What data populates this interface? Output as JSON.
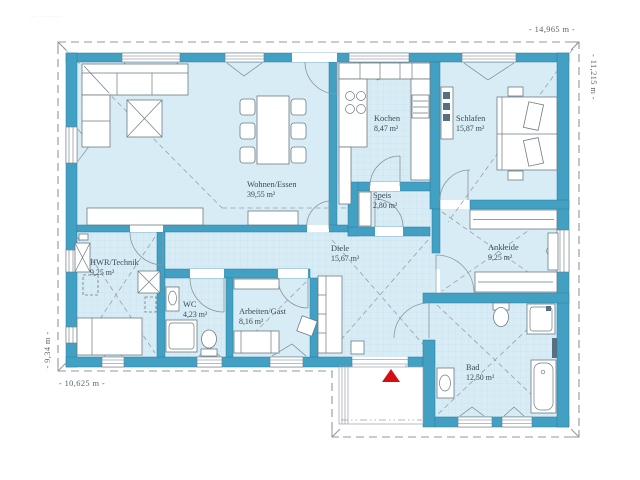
{
  "fineprint": "···· ·· ·······",
  "dimensions": {
    "top": "- 14,965 m -",
    "right": "- 11,215 m -",
    "left": "- 9,34 m -",
    "bottom": "- 10,625 m -"
  },
  "rooms": {
    "wohnen": {
      "name": "Wohnen/Essen",
      "area": "39,55 m²"
    },
    "kochen": {
      "name": "Kochen",
      "area": "8,47 m²"
    },
    "schlafen": {
      "name": "Schlafen",
      "area": "15,87 m²"
    },
    "speis": {
      "name": "Speis",
      "area": "2,80 m²"
    },
    "diele": {
      "name": "Diele",
      "area": "15,67 m²"
    },
    "hwr": {
      "name": "HWR/Technik",
      "area": "9,25 m²"
    },
    "wc": {
      "name": "WC",
      "area": "4,23 m²"
    },
    "arbeiten": {
      "name": "Arbeiten/Gast",
      "area": "8,16 m²"
    },
    "ankleide": {
      "name": "Ankleide",
      "area": "9,25 m²"
    },
    "bad": {
      "name": "Bad",
      "area": "12,50 m²"
    }
  },
  "colors": {
    "wall": "#42a0c3",
    "floor": "#d8ecf6",
    "tile_line": "#c3ddeb",
    "roof_line": "#97a1a8",
    "furniture_line": "#6e7b83",
    "label_text": "#3a4a55",
    "dimension_text": "#5a646e",
    "entrance_arrow": "#d40f12"
  }
}
